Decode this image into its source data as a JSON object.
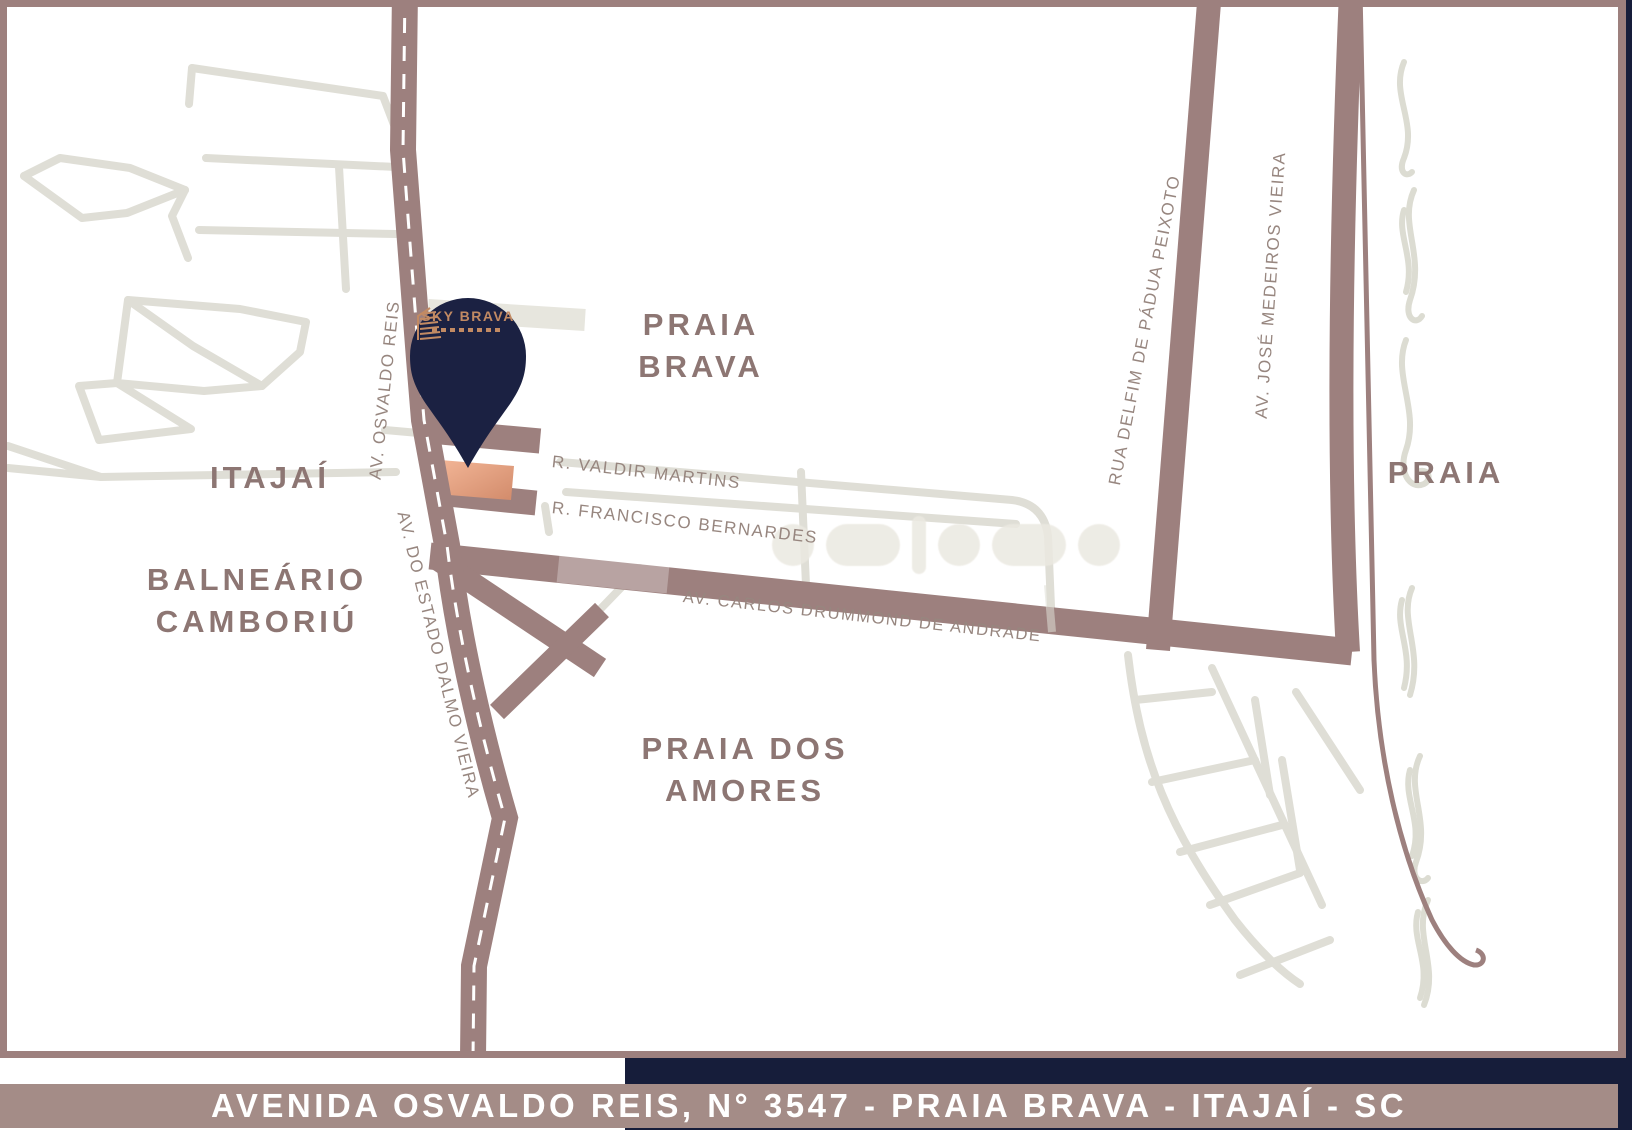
{
  "map": {
    "regions": {
      "praia_brava": {
        "line1": "PRAIA",
        "line2": "BRAVA"
      },
      "itajai": "ITAJAÍ",
      "balneario_camboriu": {
        "line1": "BALNEÁRIO",
        "line2": "CAMBORIÚ"
      },
      "praia_dos_amores": {
        "line1": "PRAIA DOS",
        "line2": "AMORES"
      },
      "praia": "PRAIA"
    },
    "streets": {
      "av_osvaldo_reis": "AV. OSVALDO REIS",
      "av_do_estado_dalmo_vieira": "AV. DO ESTADO DALMO VIEIRA",
      "r_valdir_martins": "R. VALDIR MARTINS",
      "r_francisco_bernardes": "R. FRANCISCO BERNARDES",
      "av_carlos_drummond": "AV. CARLOS DRUMMOND DE ANDRADE",
      "rua_delfim_de_padua_peixoto": "RUA DELFIM DE PÁDUA PEIXOTO",
      "av_jose_medeiros_vieira": "AV. JOSÉ MEDEIROS VIEIRA"
    },
    "pin": {
      "brand": "SKY BRAVA"
    }
  },
  "banner": {
    "address": "AVENIDA OSVALDO REIS, N° 3547 - PRAIA BRAVA - ITAJAÍ - SC"
  },
  "colors": {
    "road": "#9d807e",
    "light_street": "#dfded6",
    "navy": "#161d3a",
    "pin_navy": "#1b2142",
    "copper": "#c28a63",
    "lot_salmon": "#e8a284",
    "banner_bg": "#a48c87",
    "area_label": "#8d7673",
    "street_label": "#97867f"
  }
}
